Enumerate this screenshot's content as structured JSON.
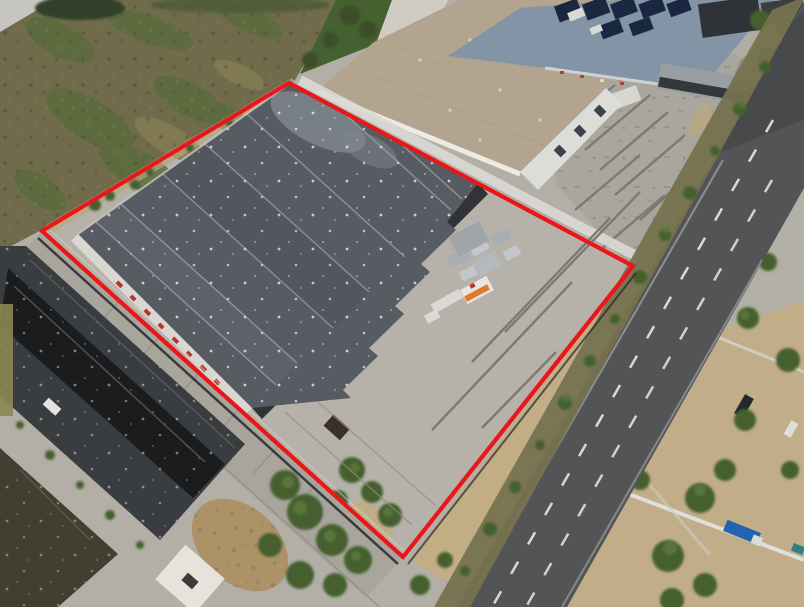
{
  "meta": {
    "description": "Aerial drone photograph of an industrial warehouse property marked with a red boundary overlay; neighboring factories, a demolition yard with concrete foundations, and a diagonal asphalt road with dashed lane markings",
    "width_px": 804,
    "height_px": 607,
    "visible_text": "none (illegible red graffiti on warehouse fascia only)"
  },
  "boundary": {
    "points": "289,83 633,266 403,557 42,231",
    "shape": "quadrilateral property outline",
    "color": "#e9161a"
  },
  "colors": {
    "boundary": "#e9161a",
    "base_concrete": "#b3afa6",
    "yard_concrete": "#b6b2a9",
    "warehouse_roof": "#575c63",
    "warehouse_roof_seam": "#9ba0a6",
    "warehouse_fascia": "#d9d7d1",
    "shadow_wall": "#26282c",
    "graffiti_red": "#b5342b",
    "tan_roof": "#b2a48f",
    "end_wall": "#dcdcd8",
    "solar_roof": "#8294a5",
    "solar_panel": "#1a2740",
    "field": "#6f6b4b",
    "field_green": "#5c6b3c",
    "demolition_concrete": "#a9a69d",
    "foundation_wall": "#7c7973",
    "road_asphalt": "#525456",
    "road_marking": "#e8e8e6",
    "ditch_scrub": "#76724f",
    "dirt": "#c2ad85",
    "tree": "#44612f",
    "tree_light": "#5b7a3e",
    "neighbor_roof": "#3a3d40",
    "neighbor_roof_dark": "#17181a",
    "olive_roof": "#403f31",
    "plaza_concrete": "#a8a59c",
    "pad_white": "#e5e3dc",
    "truck_blue": "#2563b0",
    "kiosk_orange": "#e2792c",
    "white_strip": "#dcdad5"
  },
  "scene": {
    "regions": [
      {
        "name": "dry-scrub-field",
        "position": "top-left"
      },
      {
        "name": "main-warehouse",
        "position": "center-left, inside boundary, dark gray gabled roof with skylight specks"
      },
      {
        "name": "tan-roof-building",
        "position": "top-center, neighboring plant"
      },
      {
        "name": "solar-panel-building",
        "position": "top, blue-gray roof with dark panels"
      },
      {
        "name": "demolition-yard",
        "position": "upper-right, concrete foundations"
      },
      {
        "name": "asphalt-road",
        "position": "right, diagonal two-lane with dashed markings"
      },
      {
        "name": "neighbor-factory",
        "position": "bottom-left, dark roofs"
      },
      {
        "name": "storage-yard",
        "position": "center, inside boundary with low walls, kiosk, truck"
      },
      {
        "name": "tree-clusters",
        "position": "bottom-center and along road"
      },
      {
        "name": "white-pad",
        "position": "bottom-center concrete pad with dark marker"
      }
    ]
  }
}
